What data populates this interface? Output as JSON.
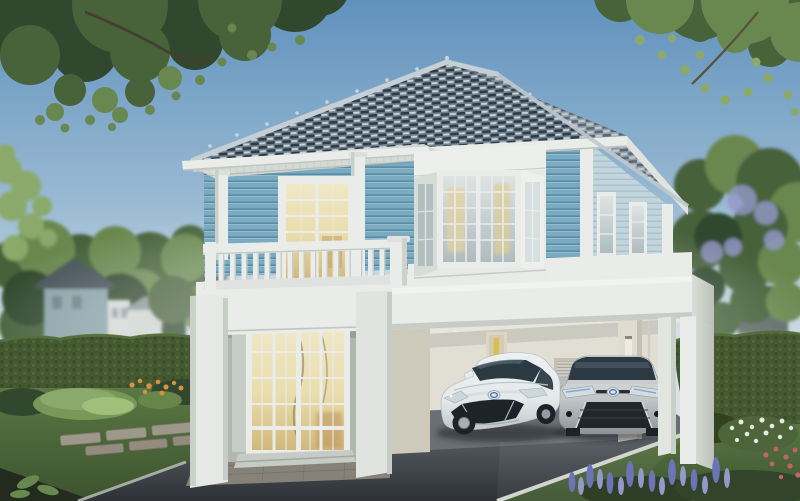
{
  "meta": {
    "type": "architectural exterior rendering",
    "subject": "two-storey house with light-blue clapboard siding, white trim, balcony and double carport with two parked sedans",
    "setting": "landscaped suburban garden, daytime clear sky"
  },
  "scene": {
    "sky": "clear blue sky fading to pale horizon",
    "background_left": "neighbouring blue-grey house behind trimmed hedge and trees",
    "background_right": "dark garden structure among trees, flowering tree overhead",
    "house": {
      "roof": "hip roof with blue-grey scalloped tiles, pale ridge caps and small finials",
      "upper_floor": "light-blue horizontal siding with white corner boards",
      "pergola": "white slatted canopy on round white columns over the balcony",
      "balcony": "white spindle balustrade with corner post",
      "balcony_door": "glazed french door glowing warm from inside",
      "bay_window": "white three-sided bay window with divided panes and warm curtains",
      "side_windows": "two narrow white-framed windows on right elevation",
      "entrance": "double-height white portico with multi-pane glass doors lit from inside",
      "carport": "open white box-frame carport with cream rear wall, service door with yellow glass slot, louvre vent and vertical wall light"
    },
    "vehicles": [
      {
        "label": "white sedan, front three-quarter view, blue-ringed emblem"
      },
      {
        "label": "silver sedan, front view, blue-ringed emblem"
      }
    ],
    "landscape": {
      "left": "hedge, ornamental grasses, orange flowers, stepping-stone path in lawn",
      "right": "hedge, white flowering shrub, purple flower spikes, pink accents",
      "foreground": "dark asphalt driveway with pale kerbs and paver apron",
      "trees": "dark canopy top-left, sunlit canopy top-right, feathery tree at left edge"
    }
  },
  "colors": {
    "sky-top": "#6496c3",
    "sky-mid": "#9fc0da",
    "sky-low": "#dbe5ea",
    "roof-base": "#71828f",
    "roof-dark": "#242f3a",
    "roof-light": "#dde5ea",
    "ridge": "#cdd6dc",
    "trim": "#f2f4f1",
    "trim-shade": "#d6dad4",
    "siding": "#7fb0c8",
    "siding-line": "#54859f",
    "siding-light": "#c9dbe3",
    "glow": "#f2e4b2",
    "glow-deep": "#d8bd7e",
    "glass": "#d5dedd",
    "glass-dark": "#2c3a44",
    "wall-cream": "#eae6db",
    "wall-cream-shade": "#d5d0c1",
    "reveal-grey": "#b7bcb6",
    "asphalt-near": "#2f3237",
    "asphalt-far": "#5c6167",
    "concrete": "#6e7278",
    "kerb": "#d8dcd4",
    "stone": "#a49d8f",
    "lawn": "#5d7b44",
    "lawn-dark": "#3e5430",
    "hedge": "#465a31",
    "hedge-light": "#5d7842",
    "hedge-dark": "#32431f",
    "leaf-dark": "#33492e",
    "leaf-mid": "#4a643a",
    "leaf-light": "#6d8c51",
    "leaf-bright": "#8fae6d",
    "flower-orange": "#dd9743",
    "flower-white": "#eef2ea",
    "flower-purple": "#7177bb",
    "flower-purple-light": "#9a9ed0",
    "flower-pink": "#c9676d",
    "car-white": "#eef1f2",
    "car-white-shade": "#c6cdd2",
    "car-silver": "#c9ccce",
    "car-silver-shade": "#94989c",
    "tyre": "#1e2226",
    "badge-blue": "#3a6db5",
    "bg-house-wall": "#8fa6ae",
    "bg-house-roof": "#46525a",
    "door-yellow": "#e7c254"
  }
}
